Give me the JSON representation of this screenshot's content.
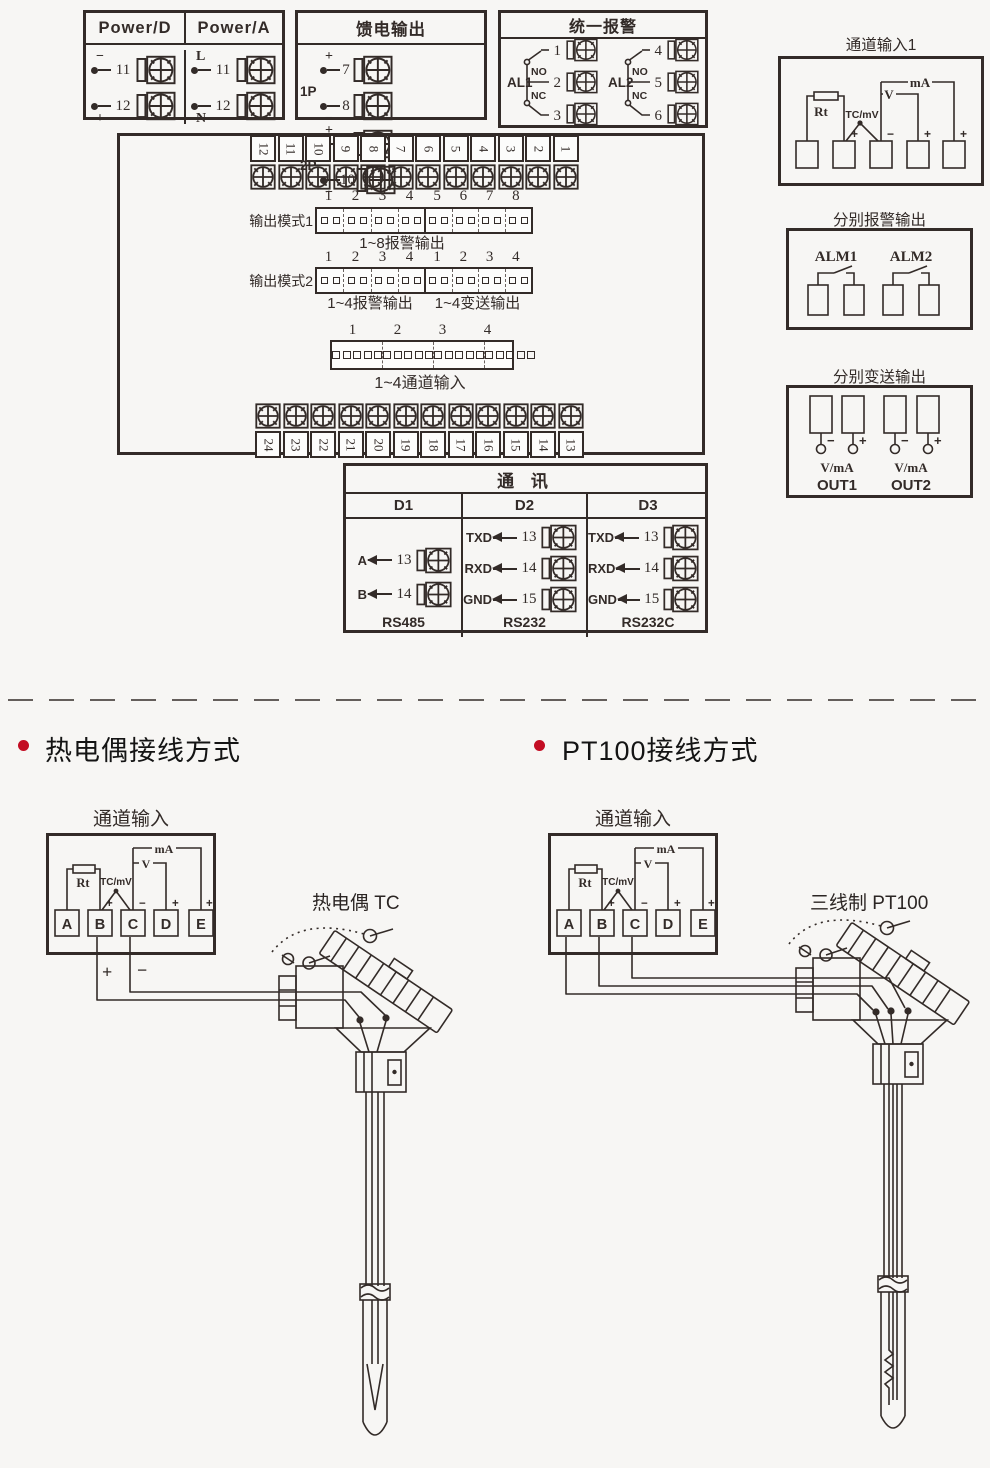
{
  "colors": {
    "line": "#332b28",
    "magenta": "#e4007f",
    "blue": "#00a0e9",
    "bullet_red": "#c30d23",
    "dash_gray": "#8f8f8f"
  },
  "power_box": {
    "headers": [
      "Power/D",
      "Power/A"
    ],
    "cols": [
      {
        "rows": [
          {
            "sign": "−",
            "num": "11"
          },
          {
            "sign": "+",
            "num": "12"
          }
        ]
      },
      {
        "rows": [
          {
            "sign": "L",
            "num": "11"
          },
          {
            "sign": "N",
            "num": "12"
          }
        ]
      }
    ]
  },
  "feed_box": {
    "title": "馈电输出",
    "groups": [
      {
        "label": "1P",
        "rows": [
          {
            "sign": "+",
            "num": "7"
          },
          {
            "sign": "−",
            "num": "8"
          }
        ]
      },
      {
        "label": "2P",
        "rows": [
          {
            "sign": "+",
            "num": "9"
          },
          {
            "sign": "−",
            "num": "10"
          }
        ]
      }
    ]
  },
  "alarm_box": {
    "title": "统一报警",
    "groups": [
      {
        "label": "AL1",
        "no": "NO",
        "nc": "NC",
        "terms": [
          "1",
          "2",
          "3"
        ]
      },
      {
        "label": "AL2",
        "no": "NO",
        "nc": "NC",
        "terms": [
          "4",
          "5",
          "6"
        ]
      }
    ]
  },
  "channel1_box": {
    "title": "通道输入1",
    "rt": "Rt",
    "tcmv": "TC/mV",
    "v": "V",
    "ma": "mA",
    "signs": [
      "+",
      "−",
      "+",
      "+"
    ]
  },
  "rear_panel": {
    "top_strip": [
      "12",
      "11",
      "10",
      "9",
      "8",
      "7",
      "6",
      "5",
      "4",
      "3",
      "2",
      "1"
    ],
    "bottom_strip": [
      "24",
      "23",
      "22",
      "21",
      "20",
      "19",
      "18",
      "17",
      "16",
      "15",
      "14",
      "13"
    ],
    "mode1": {
      "label": "输出模式1",
      "nums_a": [
        "1",
        "2",
        "3",
        "4"
      ],
      "nums_b": [
        "5",
        "6",
        "7",
        "8"
      ],
      "caption": "1~8报警输出"
    },
    "mode2": {
      "label": "输出模式2",
      "nums_a": [
        "1",
        "2",
        "3",
        "4"
      ],
      "nums_b": [
        "1",
        "2",
        "3",
        "4"
      ],
      "caption_a": "1~4报警输出",
      "caption_b": "1~4变送输出"
    },
    "channels": {
      "nums": [
        "1",
        "2",
        "3",
        "4"
      ],
      "caption": "1~4通道输入"
    }
  },
  "alarm_out_box": {
    "title": "分别报警输出",
    "labels": [
      "ALM1",
      "ALM2"
    ]
  },
  "transmit_out_box": {
    "title": "分别变送输出",
    "signs": [
      "−",
      "+",
      "−",
      "+"
    ],
    "vma": [
      "V/mA",
      "V/mA"
    ],
    "outs": [
      "OUT1",
      "OUT2"
    ]
  },
  "comm_box": {
    "title": "通  讯",
    "cols": [
      {
        "name": "D1",
        "rows": [
          {
            "label": "A",
            "num": "13"
          },
          {
            "label": "B",
            "num": "14"
          }
        ],
        "footer": "RS485"
      },
      {
        "name": "D2",
        "rows": [
          {
            "label": "TXD",
            "num": "13"
          },
          {
            "label": "RXD",
            "num": "14"
          },
          {
            "label": "GND",
            "num": "15"
          }
        ],
        "footer": "RS232"
      },
      {
        "name": "D3",
        "rows": [
          {
            "label": "TXD",
            "num": "13"
          },
          {
            "label": "RXD",
            "num": "14"
          },
          {
            "label": "GND",
            "num": "15"
          }
        ],
        "footer": "RS232C"
      }
    ]
  },
  "tc_section": {
    "heading": "热电偶接线方式",
    "box_title": "通道输入",
    "terminals": [
      "A",
      "B",
      "C",
      "D",
      "E"
    ],
    "signs": [
      "+",
      "−",
      "+",
      "+"
    ],
    "rt": "Rt",
    "tcmv": "TC/mV",
    "v": "V",
    "ma": "mA",
    "wire_plus": "+",
    "wire_minus": "−",
    "sensor_label": "热电偶 TC"
  },
  "pt_section": {
    "heading": "PT100接线方式",
    "box_title": "通道输入",
    "terminals": [
      "A",
      "B",
      "C",
      "D",
      "E"
    ],
    "signs": [
      "+",
      "−",
      "+",
      "+"
    ],
    "rt": "Rt",
    "tcmv": "TC/mV",
    "v": "V",
    "ma": "mA",
    "sensor_label": "三线制 PT100"
  }
}
